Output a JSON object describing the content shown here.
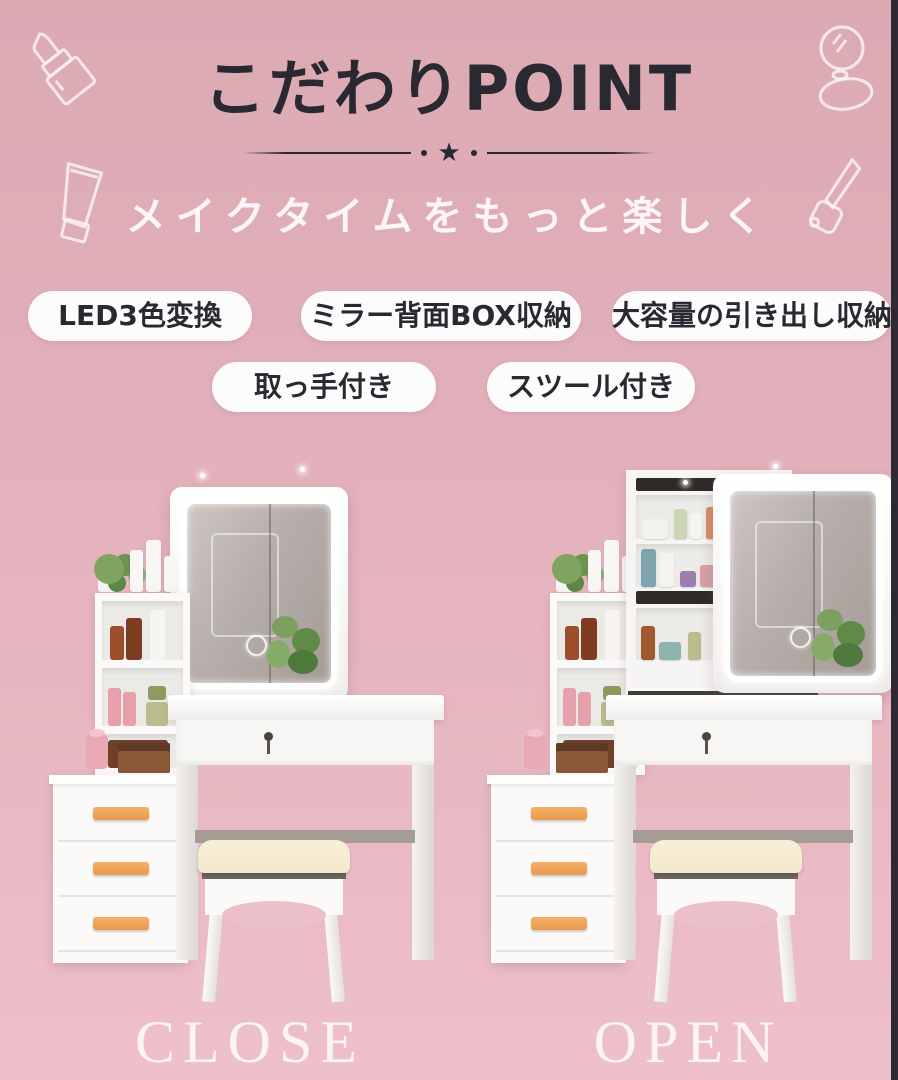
{
  "header": {
    "title": "こだわりPOINT",
    "divider_star": "★",
    "subtitle": "メイクタイムをもっと楽しく"
  },
  "feature_badges": [
    "LED3色変換",
    "ミラー背面BOX収納",
    "大容量の引き出し収納",
    "取っ手付き",
    "スツール付き"
  ],
  "products": [
    {
      "label": "CLOSE"
    },
    {
      "label": "OPEN"
    }
  ],
  "decor_icons": [
    "lipstick-icon",
    "compact-mirror-icon",
    "cosmetic-tube-icon",
    "nail-polish-icon"
  ],
  "colors": {
    "bg_top": "#dcaab3",
    "bg_mid": "#e2b0ba",
    "bg_bottom": "#eec0c9",
    "ink": "#2a2932",
    "badge_bg": "#fdfcfc",
    "handle": "#e99a4c",
    "cushion": "#f2e8cd",
    "edge": "#2e2933"
  }
}
